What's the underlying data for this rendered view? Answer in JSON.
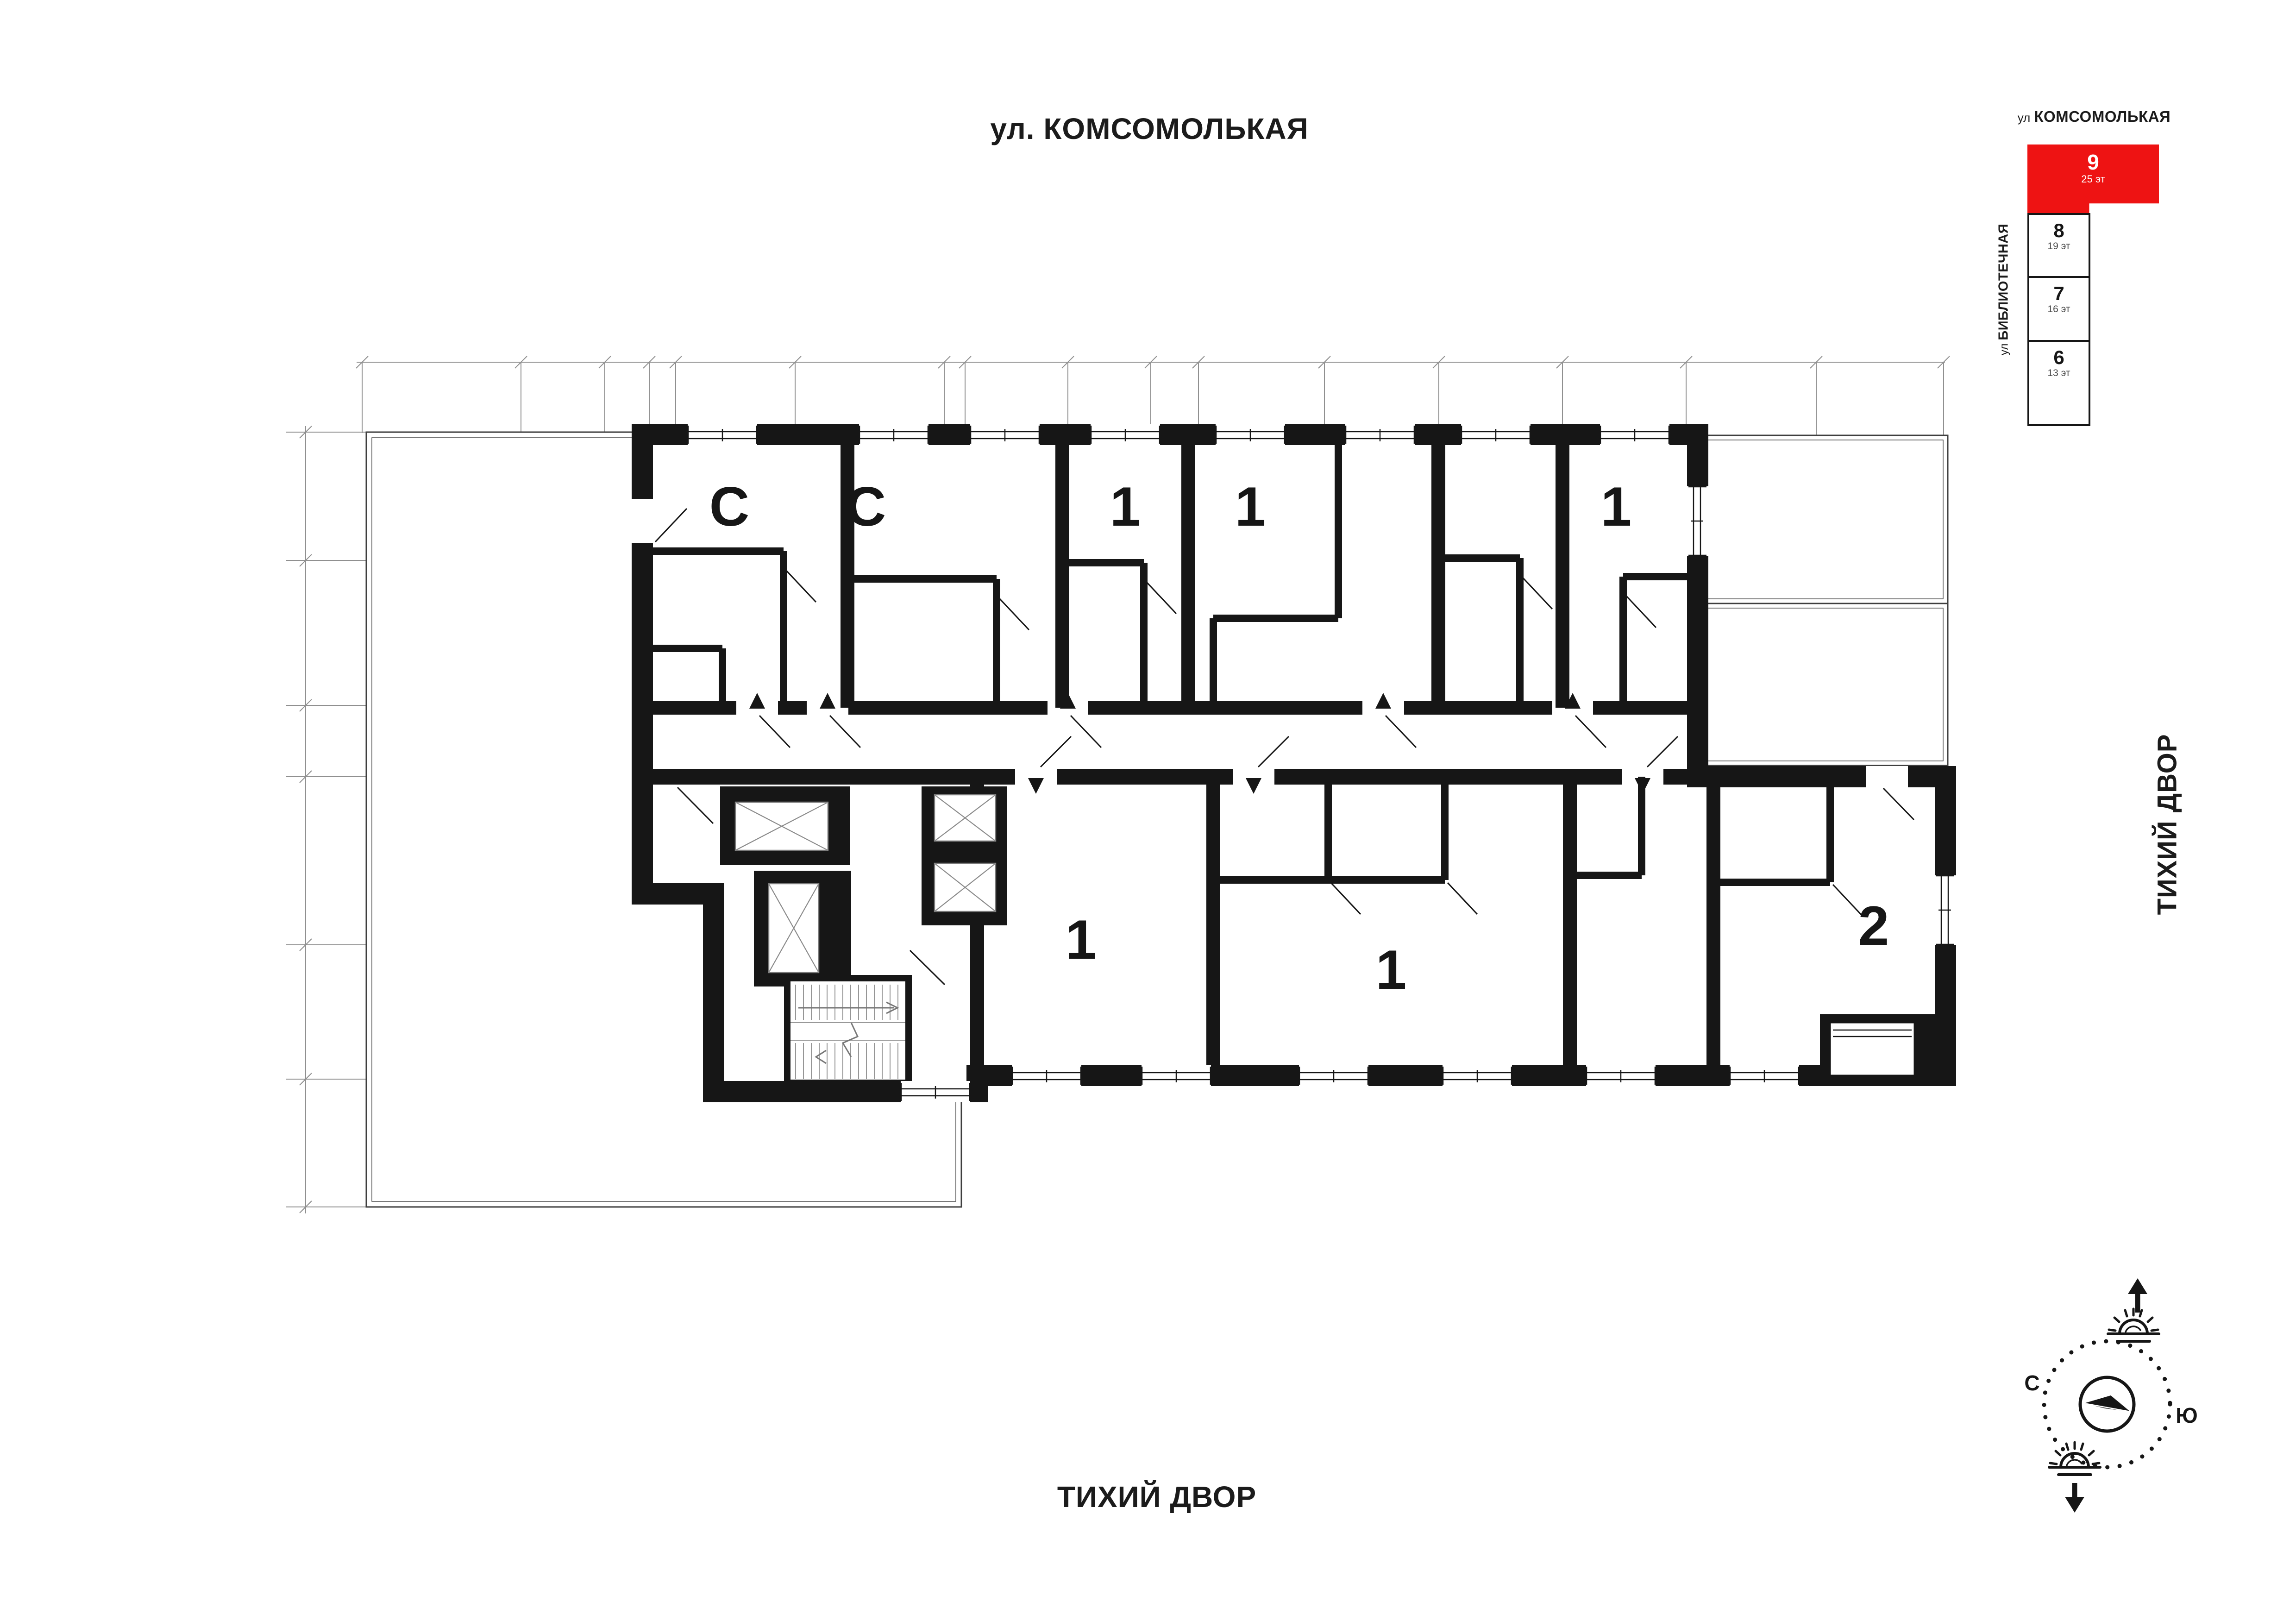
{
  "titles": {
    "street_top": "ул. КОМСОМОЛЬКАЯ",
    "courtyard_bottom": "ТИХИЙ ДВОР",
    "courtyard_right": "ТИХИЙ ДВОР"
  },
  "minimap": {
    "street_top_prefix": "ул",
    "street_top_name": "КОМСОМОЛЬКАЯ",
    "street_side_prefix": "ул",
    "street_side_name": "БИБЛИОТЕЧНАЯ",
    "accent_color": "#ee1313",
    "blocks": [
      {
        "number": "9",
        "floors": "25 эт",
        "selected": true
      },
      {
        "number": "8",
        "floors": "19 эт",
        "selected": false
      },
      {
        "number": "7",
        "floors": "16 эт",
        "selected": false
      },
      {
        "number": "6",
        "floors": "13 эт",
        "selected": false
      }
    ]
  },
  "compass": {
    "north_label": "С",
    "south_label": "Ю"
  },
  "plan": {
    "apartments_top": [
      "С",
      "С",
      "1",
      "1",
      "1"
    ],
    "apartments_bottom": [
      "1",
      "1",
      "2"
    ]
  }
}
